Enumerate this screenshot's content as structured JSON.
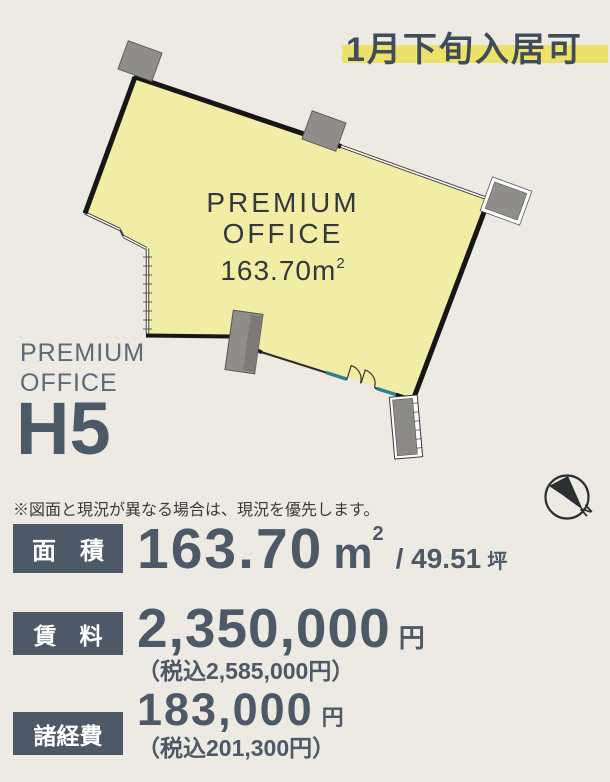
{
  "banner": {
    "text": "1月下旬入居可"
  },
  "plan": {
    "room_line1": "PREMIUM",
    "room_line2": "OFFICE",
    "area_text": "163.70m",
    "area_sup": "2"
  },
  "unit": {
    "brand_line1": "PREMIUM",
    "brand_line2": "OFFICE",
    "name": "H5"
  },
  "disclaimer": "※図面と現況が異なる場合は、現況を優先します。",
  "compass": {
    "north_label": "N"
  },
  "specs": {
    "area": {
      "label": "面　積",
      "value": "163.70",
      "unit_base": "m",
      "unit_sup": "2",
      "secondary": "/ 49.51",
      "secondary_unit": "坪"
    },
    "rent": {
      "label": "賃　料",
      "value": "2,350,000",
      "unit": "円",
      "tax_note": "（税込2,585,000円）"
    },
    "expenses": {
      "label": "諸経費",
      "value": "183,000",
      "unit": "円",
      "tax_note": "（税込201,300円）"
    }
  },
  "colors": {
    "background": "#eceae2",
    "room_fill": "#f2eda5",
    "wall": "#161616",
    "slate": "#4d5966",
    "brand_text": "#5b6a79",
    "banner_highlight": "#ece269",
    "banner_text": "#414c5a",
    "pillar_gray": "#8f8e8b",
    "window_sill_teal": "#2d7f91"
  }
}
